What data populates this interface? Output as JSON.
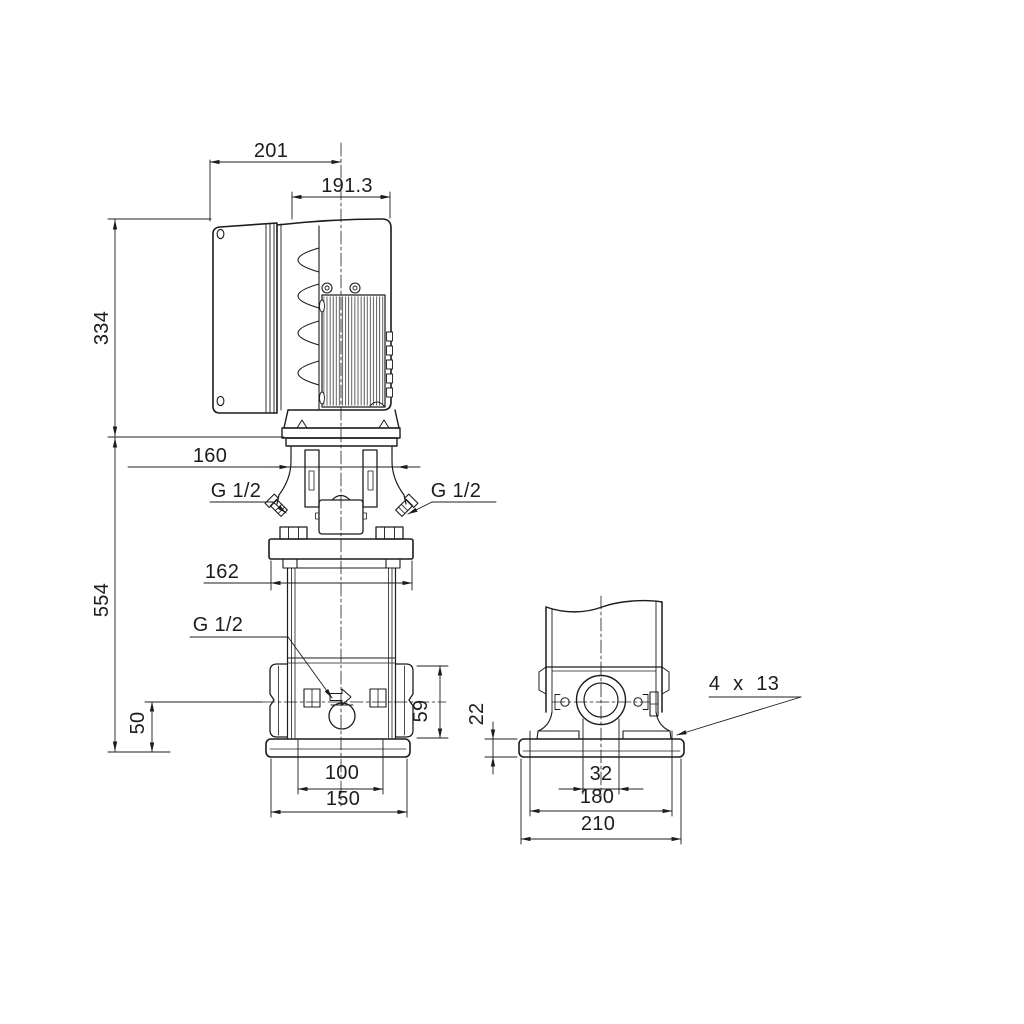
{
  "drawing": {
    "type": "dimensional technical drawing - vertical multistage pump, side view and end view",
    "colors": {
      "line": "#1c1c1c",
      "background": "#ffffff"
    },
    "side_view": {
      "dims": {
        "top_width": "201",
        "motor_width": "191.3",
        "motor_height": "334",
        "coupling_width": "160",
        "pump_height": "554",
        "head_flange_width": "162",
        "port_axis_height": "50",
        "port_flange_height": "59",
        "base_bolt_spacing": "100",
        "base_width": "150"
      },
      "ports": {
        "gauge_left": "G 1/2",
        "gauge_right": "G 1/2",
        "drain": "G 1/2"
      }
    },
    "end_view": {
      "dims": {
        "base_plate_height": "22",
        "port_bore": "32",
        "base_bolt_spacing": "180",
        "base_width": "210"
      },
      "notes": {
        "bolt_holes": "4 x 13"
      }
    }
  }
}
